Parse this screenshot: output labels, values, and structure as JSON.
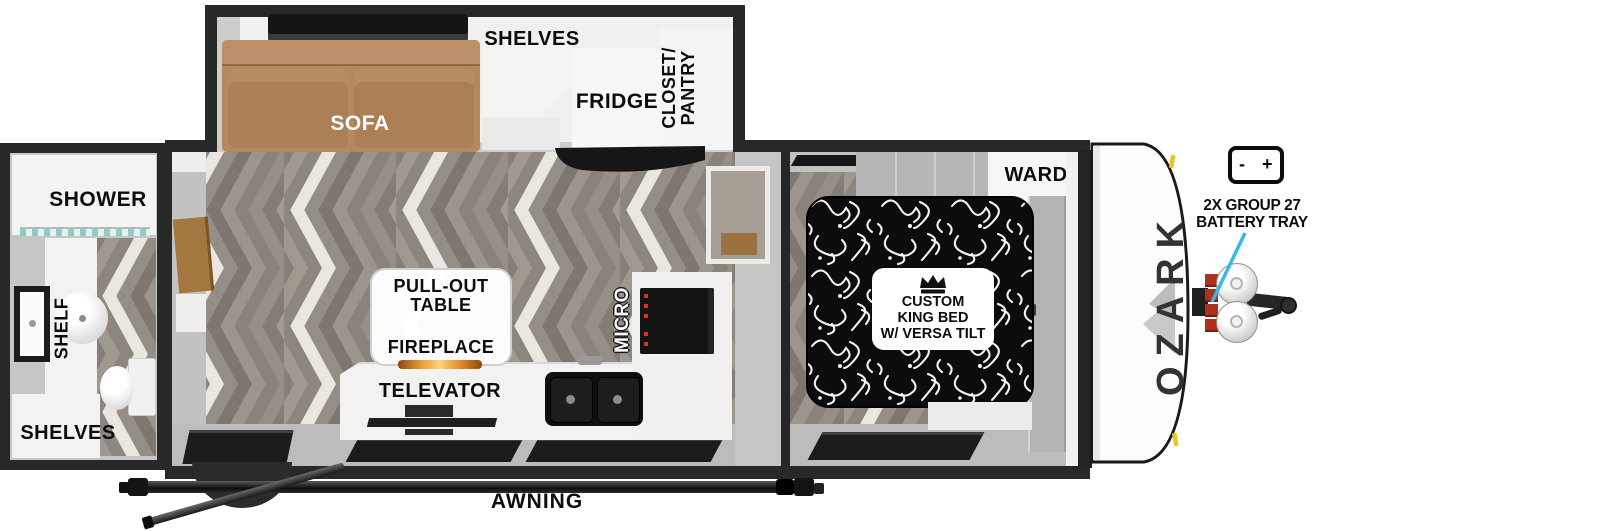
{
  "brand": "OZARK",
  "colors": {
    "wall_border": "#282828",
    "interior_gray": "#c6c6c5",
    "floor_gray": "#938c84",
    "sofa_brown": "#b3895f",
    "accent_callout_cyan": "#35b7ea",
    "battery_tray_red": "#b0301e",
    "clearance_light_yellow": "#ecc51b",
    "flame_orange": "#f0a23c"
  },
  "slideout": {
    "sofa": "SOFA",
    "shelves": "SHELVES",
    "fridge": "FRIDGE",
    "closet_pantry_line1": "CLOSET/",
    "closet_pantry_line2": "PANTRY"
  },
  "bathroom": {
    "shower": "SHOWER",
    "shelf": "SHELF",
    "shelves": "SHELVES"
  },
  "kitchen": {
    "pullout_line1": "PULL-OUT",
    "pullout_line2": "TABLE",
    "fireplace": "FIREPLACE",
    "televator": "TELEVATOR",
    "micro": "MICRO"
  },
  "bedroom": {
    "ward": "WARD",
    "bed_line1": "CUSTOM",
    "bed_line2": "KING BED",
    "bed_line3": "W/ VERSA TILT"
  },
  "exterior": {
    "awning": "AWNING",
    "battery_callout_line1": "2X GROUP 27",
    "battery_callout_line2": "BATTERY TRAY",
    "battery_minus": "-",
    "battery_plus": "+"
  }
}
